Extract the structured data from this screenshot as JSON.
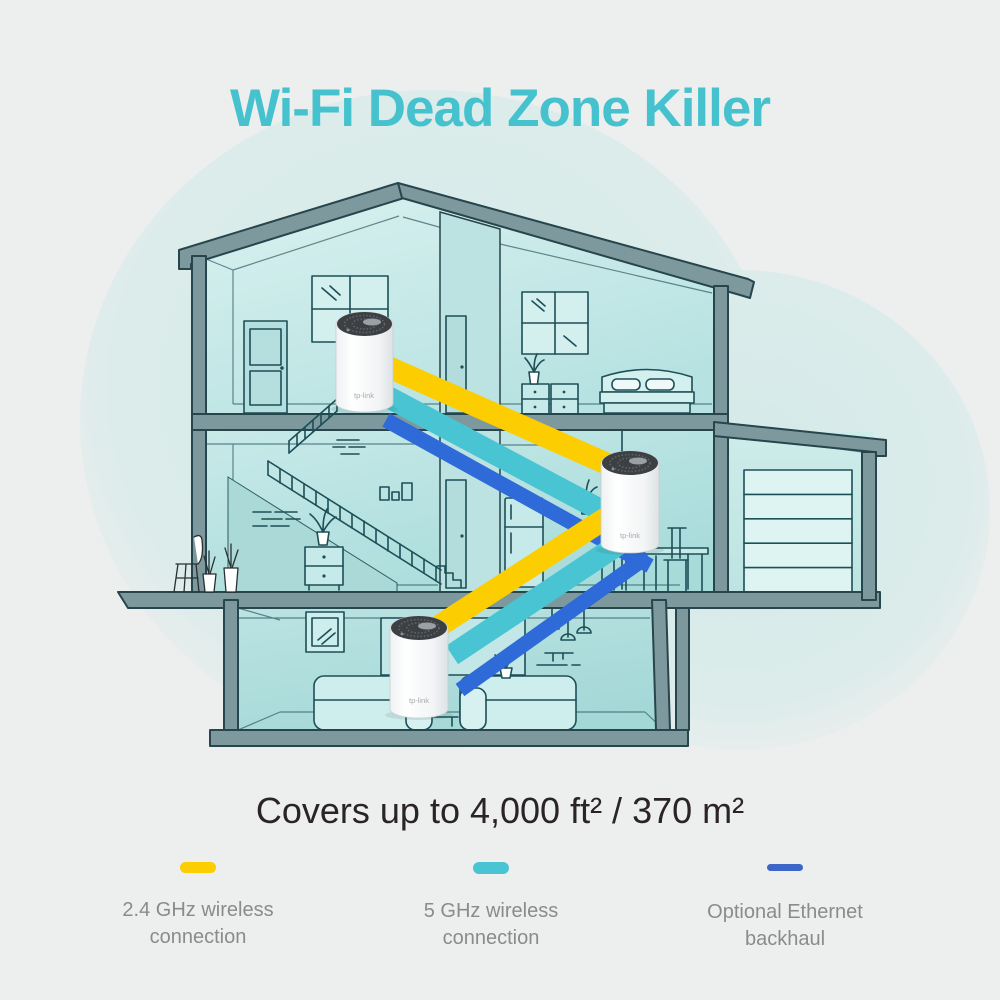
{
  "page": {
    "background": "#edeeee"
  },
  "title": {
    "text": "Wi-Fi Dead Zone Killer",
    "color": "#45c2cd"
  },
  "coverage": {
    "text": "Covers up to 4,000 ft² / 370 m²",
    "color": "#2a2427"
  },
  "legend": {
    "text_color": "#8b8b8e",
    "items": [
      {
        "line1": "2.4 GHz wireless",
        "line2": "connection",
        "color": "#fccd00"
      },
      {
        "line1": "5 GHz wireless",
        "line2": "connection",
        "color": "#48c4d2"
      },
      {
        "line1": "Optional Ethernet",
        "line2": "backhaul",
        "color": "#3c67c8"
      }
    ]
  },
  "illustration": {
    "type": "house-cutaway-mesh-network",
    "deco_unit_count": 3,
    "device_logo": "tp-link",
    "bands": [
      {
        "name": "2.4 GHz wireless connection",
        "color": "#fccd00"
      },
      {
        "name": "5 GHz wireless connection",
        "color": "#48c4d2"
      },
      {
        "name": "Optional Ethernet backhaul",
        "color": "#2f6bd8"
      }
    ],
    "structure_color": "#7e999e",
    "outline_color": "#26454c",
    "room_fill": "#c3e7e6",
    "background_blob": "#d5ebe9"
  }
}
